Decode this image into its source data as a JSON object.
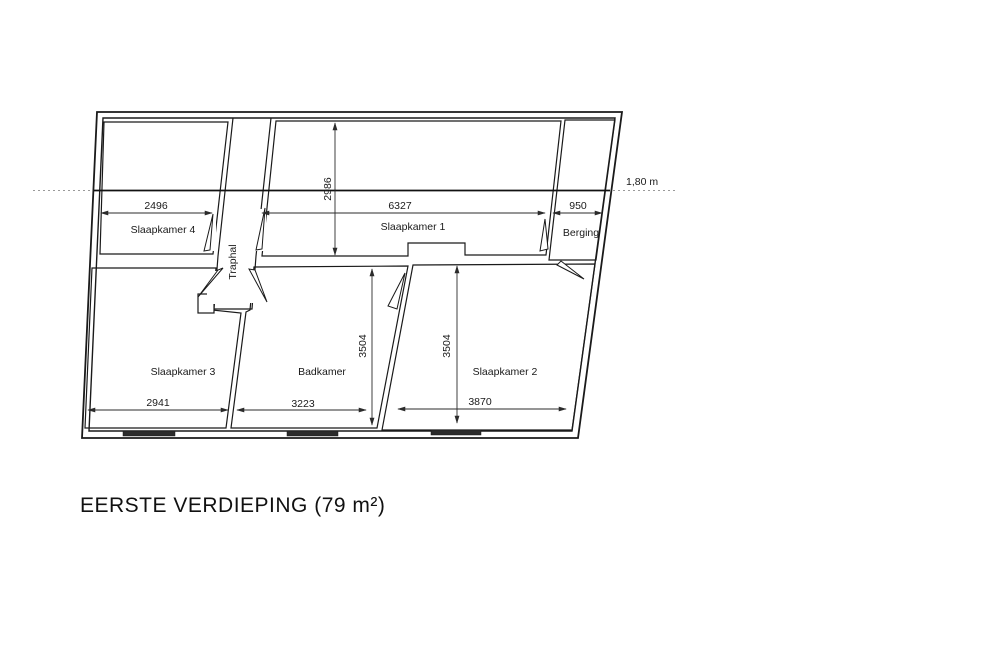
{
  "page": {
    "title": "EERSTE VERDIEPING (79 m²)"
  },
  "annotations": {
    "height_line_label": "1,80 m"
  },
  "rooms": {
    "slaapkamer1": {
      "label": "Slaapkamer 1",
      "width": "6327",
      "depth": "2986"
    },
    "slaapkamer2": {
      "label": "Slaapkamer 2",
      "width": "3870",
      "depth": "3504"
    },
    "slaapkamer3": {
      "label": "Slaapkamer 3",
      "width": "2941"
    },
    "slaapkamer4": {
      "label": "Slaapkamer 4",
      "width": "2496"
    },
    "badkamer": {
      "label": "Badkamer",
      "width": "3223",
      "depth": "3504"
    },
    "berging": {
      "label": "Berging",
      "width": "950"
    },
    "traphal": {
      "label": "Traphal"
    }
  },
  "colors": {
    "wall": "#1a1a1a",
    "dimension": "#2b2b2b",
    "text": "#1a1a1a",
    "height_line": "#111111",
    "window": "#2b2b2b"
  }
}
